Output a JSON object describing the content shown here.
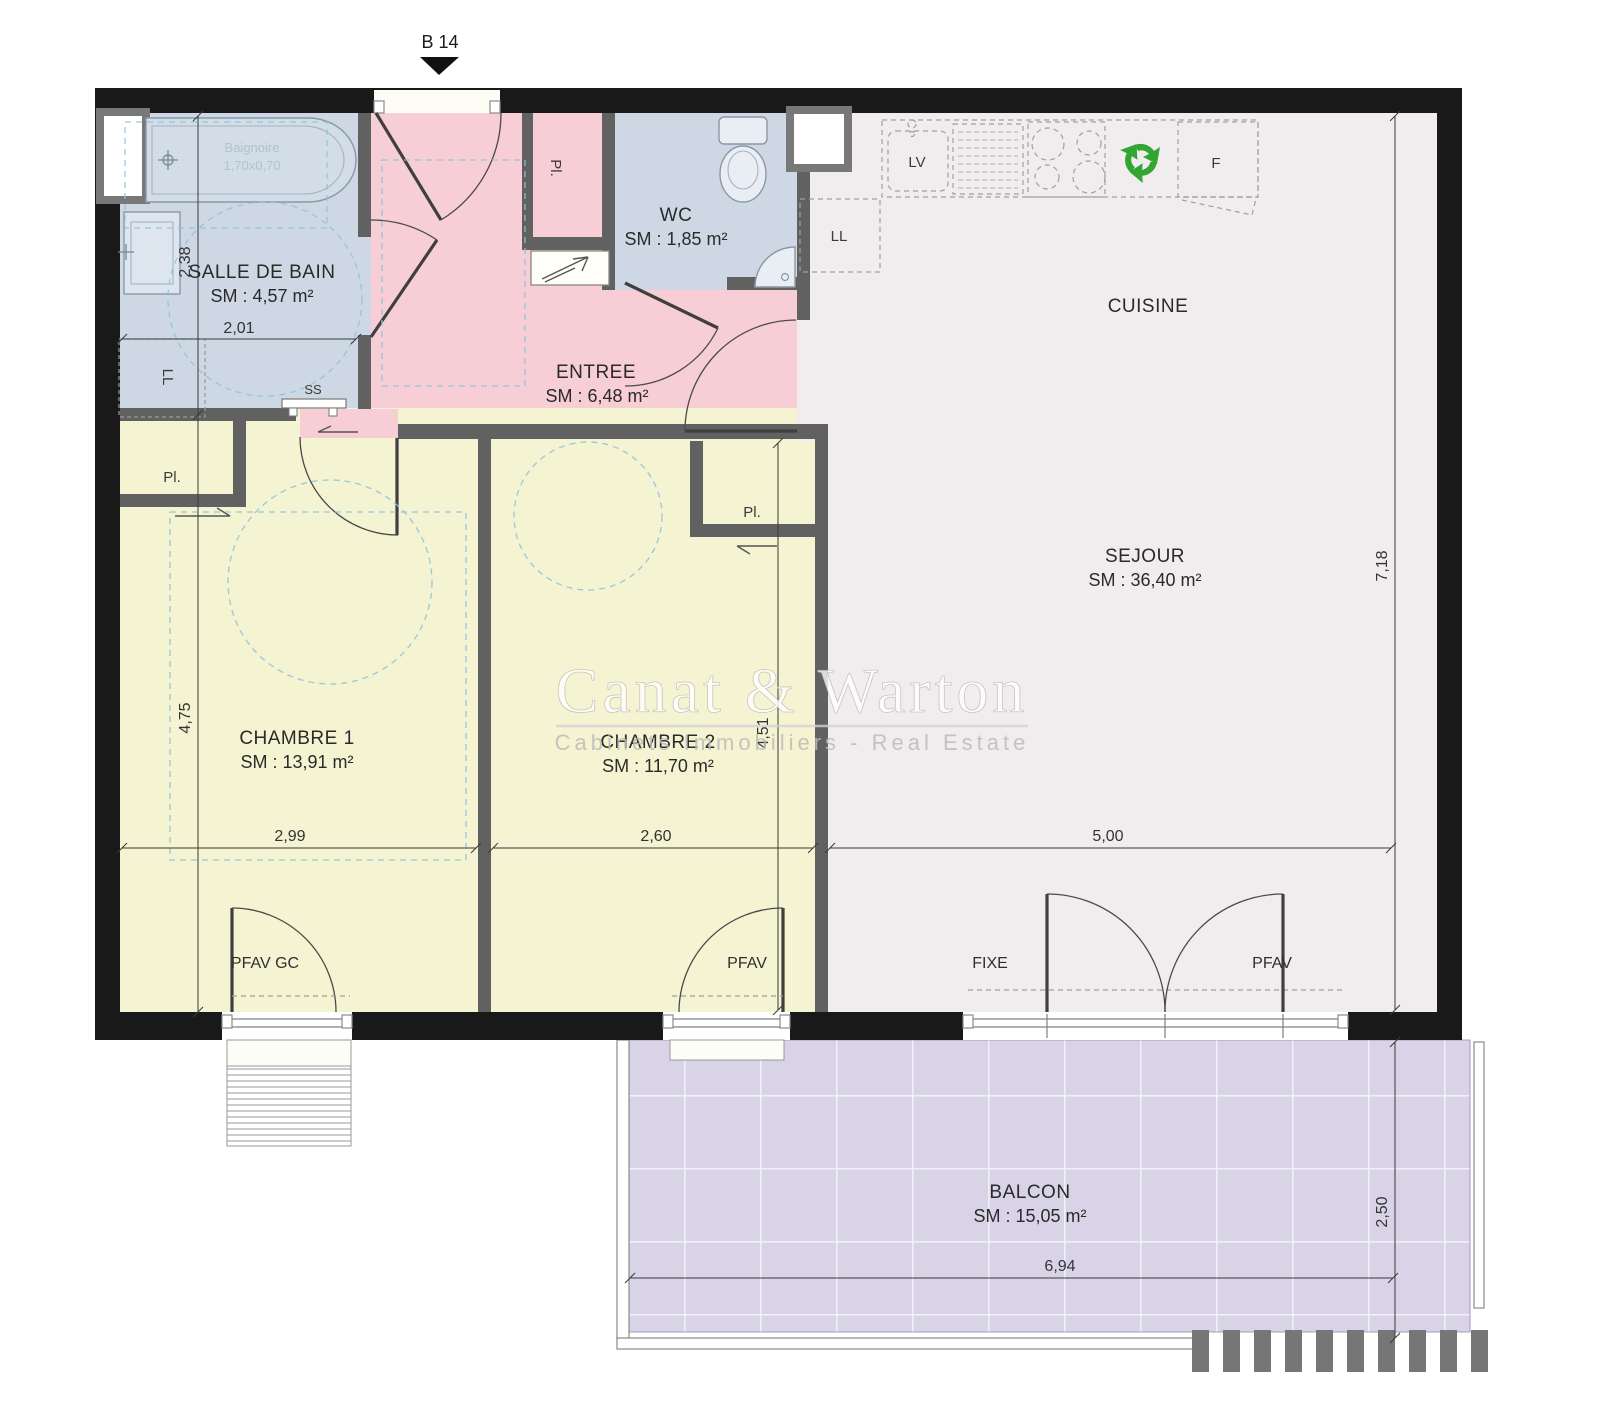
{
  "marker": {
    "label": "B 14"
  },
  "watermark": {
    "brand": "Canat & Warton",
    "tagline": "Cabinets Immobiliers - Real Estate"
  },
  "rooms": {
    "salle_de_bain": {
      "name": "SALLE DE BAIN",
      "area": "SM : 4,57 m²"
    },
    "wc": {
      "name": "WC",
      "area": "SM : 1,85 m²"
    },
    "entree": {
      "name": "ENTREE",
      "area": "SM : 6,48 m²"
    },
    "cuisine": {
      "name": "CUISINE"
    },
    "sejour": {
      "name": "SEJOUR",
      "area": "SM : 36,40 m²"
    },
    "chambre_1": {
      "name": "CHAMBRE 1",
      "area": "SM : 13,91 m²"
    },
    "chambre_2": {
      "name": "CHAMBRE 2",
      "area": "SM : 11,70 m²"
    },
    "balcon": {
      "name": "BALCON",
      "area": "SM : 15,05 m²"
    }
  },
  "labels": {
    "bath": "Baignoire",
    "bath_dims": "1,70x0,70",
    "washing_machine": "LL",
    "washing_machine_kitchen": "LL",
    "towel_dryer": "SS",
    "dishwasher": "LV",
    "fridge": "F",
    "closet_entree": "Pl.",
    "closet_chambre_1": "Pl.",
    "closet_chambre_2": "Pl."
  },
  "window_labels": {
    "chambre_1": "PFAV GC",
    "chambre_2": "PFAV",
    "sejour_fixed": "FIXE",
    "sejour_opening": "PFAV"
  },
  "dimensions": {
    "sdb_height": "2,38",
    "sdb_width": "2,01",
    "chambre_1_height": "4,75",
    "chambre_1_width": "2,99",
    "chambre_2_width": "2,60",
    "chambre_2_height": "4,51",
    "sejour_width": "5,00",
    "sejour_height": "7,18",
    "balcon_width": "6,94",
    "balcon_depth": "2,50"
  },
  "colors": {
    "wall": "#191919",
    "inner_wall": "#616161",
    "bathroom": "#cdd8e4",
    "entry": "#f7ced5",
    "bedroom": "#f4f3d2",
    "living": "#f1eced",
    "balcony": "#d9d3e7",
    "recycle": "#33a532",
    "guide": "#8fc3dd"
  }
}
